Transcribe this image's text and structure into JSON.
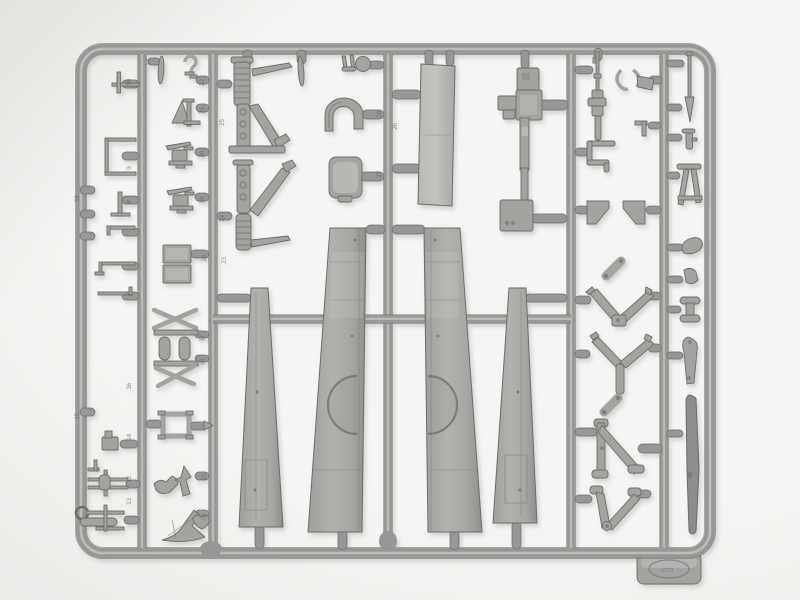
{
  "scene": {
    "description": "Photograph of a grey injection-moulded plastic model-kit sprue (parts frame) for a biplane aircraft: two large tapered upper-wing halves and two narrow lower-wing strips in the centre, flanked by sprung tail-skid struts, a cowl piece, a bucket seat, a large flat panel, a radiator pylon, a machine gun, V-shaped undercarriage struts, triangular frames and many small fittings, all joined by oval gates to a rounded rectangular runner with embossed part numbers and a moulded maker's tab at the lower right.",
    "object": "injection-moulded styrene sprue",
    "background": "plain light grey studio surface"
  },
  "colors": {
    "background": "#f6f5f3",
    "background_edge": "#e7e6e3",
    "plastic": "#989795",
    "plastic_hi": "#c9c8c5",
    "plastic_dk": "#6f6e6c",
    "plastic_part": "#a5a3a0",
    "emboss": "#5f5e5c",
    "shadow": "#8a8886"
  },
  "logo": {
    "brand": "icm"
  },
  "labels": [
    "14",
    "10",
    "22",
    "21",
    "9",
    "55",
    "20",
    "8",
    "19",
    "18",
    "7",
    "25",
    "24",
    "23",
    "28",
    "27",
    "26",
    "17",
    "18",
    "15",
    "16",
    "14",
    "12",
    "13",
    "15",
    "16"
  ]
}
